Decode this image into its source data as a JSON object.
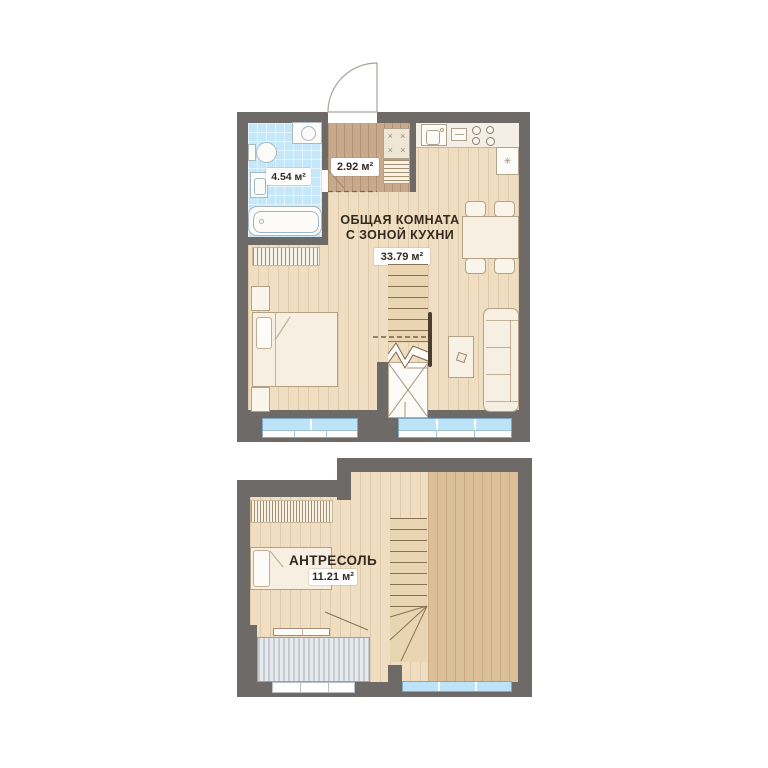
{
  "page": {
    "description": "Two-level apartment floor plan (main level and mezzanine)"
  },
  "colors": {
    "wall": "#6e6a67",
    "floor_light_wood": "#efdec2",
    "floor_hall_wood": "#c8a98c",
    "floor_dark_wood": "#dcc099",
    "bathroom_tile": "#c4e7f9",
    "window_glass": "#bce3f8",
    "entrance_arrow_green": "#1fa64e",
    "label_text": "#33291f",
    "stripe_block": "#e8ebee"
  },
  "glyphs": {
    "closet_x": "×",
    "fridge_snowflake": "✳"
  },
  "upper_plan": {
    "living_room": {
      "title_line1": "ОБЩАЯ КОМНАТА",
      "title_line2": "С ЗОНОЙ КУХНИ",
      "area": "33.79 м²"
    },
    "bathroom": {
      "area": "4.54 м²"
    },
    "hallway": {
      "area": "2.92 м²"
    }
  },
  "lower_plan": {
    "mezzanine": {
      "title": "АНТРЕСОЛЬ",
      "area": "11.21 м²"
    }
  }
}
